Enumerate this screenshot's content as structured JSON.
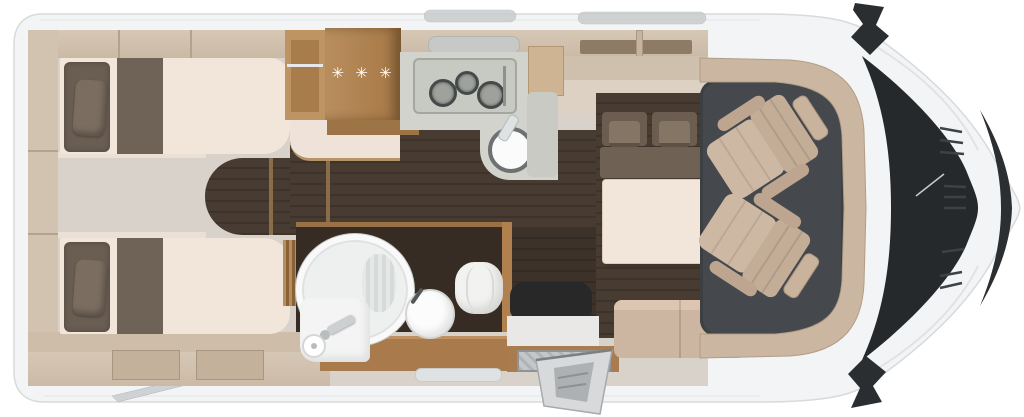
{
  "floorplan": {
    "view": "motorhome-top-view-floor-plan",
    "kitchen": {
      "wardrobe_label": "✳ ✳ ✳",
      "burner_count": 3,
      "elements": [
        "tall-wardrobe",
        "shelf-unit",
        "three-burner-stove",
        "round-sink",
        "worktop",
        "side-counter",
        "overhead-cabinet"
      ]
    },
    "rear_bedroom": {
      "elements": [
        "single-bed-top",
        "single-bed-bottom",
        "bed-pillow-top",
        "bed-pillow-bottom",
        "rear-shelf-wall",
        "overhead-lockers",
        "center-step-platform",
        "aisle-dark-floor"
      ]
    },
    "bathroom": {
      "elements": [
        "round-shower-cabin",
        "washbasin",
        "toilet",
        "vanity-with-faucet",
        "toilet-paper-roll",
        "folding-door",
        "bathroom-cabinet"
      ]
    },
    "dinette": {
      "elements": [
        "bench-backrest-cushion-left",
        "bench-backrest-cushion-right",
        "bench-pillow-left",
        "bench-pillow-right",
        "bench-seat",
        "dinette-table",
        "side-bench"
      ]
    },
    "cab": {
      "elements": [
        "driver-swivel-seat",
        "passenger-swivel-seat",
        "dashboard-console",
        "cab-floor-mat",
        "windshield",
        "front-nose-trim",
        "grille-vents",
        "side-mirror-top",
        "side-mirror-bottom"
      ]
    },
    "exterior": {
      "elements": [
        "vehicle-body",
        "entry-door-open",
        "entry-step",
        "awning-support-arm",
        "roof-vent-left",
        "roof-vent-right",
        "hood-seam-lines"
      ]
    },
    "colors": {
      "body": "#f3f4f5",
      "body_line": "#d7dadc",
      "floor_light": "#d8d2ca",
      "wood_light": "#d2c3b0",
      "wood_mid": "#a87a4c",
      "wood_dark": "#9a7245",
      "floor_dark": "#463a31",
      "cream": "#f2e5da",
      "cushion_dark": "#6c5e51",
      "seat_tan": "#cdb8a3",
      "cab_mat": "#45494d",
      "glass_dark": "#26292b",
      "counter_grey": "#d2d3cd",
      "white": "#ffffff"
    }
  }
}
